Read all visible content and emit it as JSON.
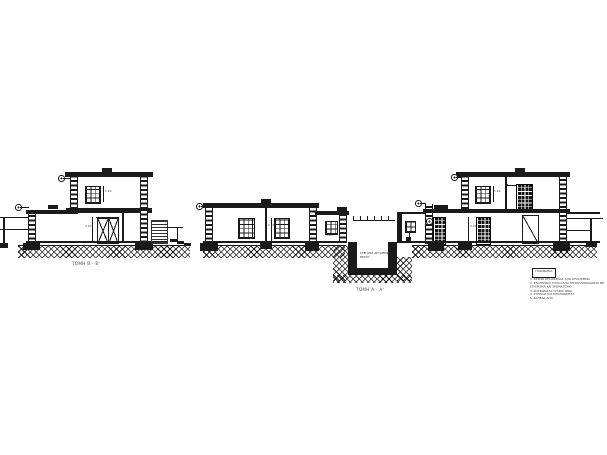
{
  "colors": {
    "ink": "#1a1a1a",
    "paper": "#ffffff",
    "muted": "#555555"
  },
  "sections": {
    "b": {
      "label": "ΤΟΜΗ Β - Β'"
    },
    "a": {
      "label": "ΤΟΜΗ Α - Α'",
      "basement": {
        "line1": "ΣΤΕΓΑΝΗ ΔΕΞΑΜΕΝΗ",
        "line2": "ΝΕΡΟΥ"
      }
    }
  },
  "dims": {
    "b_window": "1.20",
    "b_door": "2.20",
    "a_room": "2.20",
    "a_small_window": "0.90",
    "c_window": "1.20",
    "c_room": "2.20"
  },
  "legend": {
    "title": "ΥΠΟΜΝΗΜΑ",
    "notes": [
      "1. ΦΕΡΩΝ ΟΡΓΑΝΙΣΜΟΣ ΑΠΟ ΟΠΛΙΣΜΕΝΟ ΣΚΥΡΟΔΕΜΑ",
      "2. ΕΞΩΤΕΡΙΚΟΙ ΤΟΙΧΟΙ ΑΠΟ ΟΠΤΟΠΛΙΝΘΟΔΟΜΗ ΜΕ ΕΠΙΧΡΙΣΜΑ ΚΑΙ ΧΡΩΜΑΤΙΣΜΟ",
      "3. ΚΟΥΦΩΜΑΤΑ ΞΥΛΙΝΑ ΧΡΩΜΑΤΙΣΜΕΝΑ",
      "4. ΣΤΗΘΑΙΑ ΚΑΙ ΚΙΓΚΛΙΔΩΜΑΤΑ ΣΙΔΗΡΑ",
      "5. ΔΑΠΕΔΑ ΑΠΟ ΜΑΡΜΑΡΟ"
    ]
  }
}
